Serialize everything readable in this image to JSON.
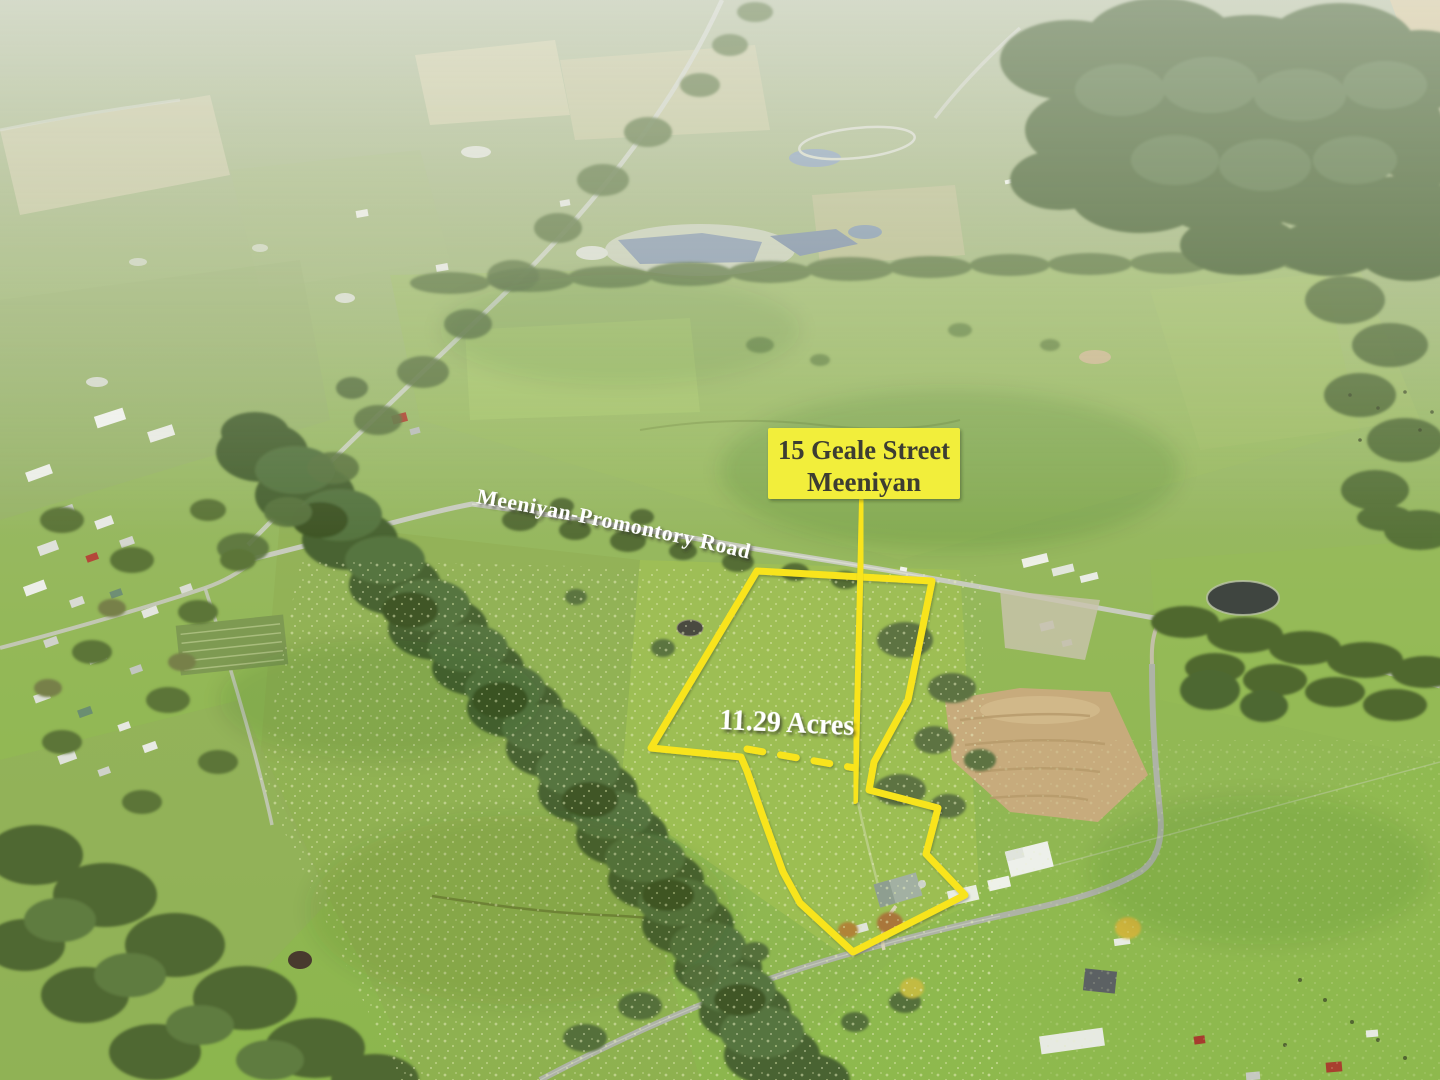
{
  "annotations": {
    "property_label": {
      "line1": "15 Geale Street",
      "line2": "Meeniyan"
    },
    "road_label": "Meeniyan-Promontory Road",
    "area_label": "11.29 Acres"
  },
  "colors": {
    "overlay_yellow": "#F8E41C",
    "label_box_fill": "#F2EE3B",
    "label_text_dark": "#3C3C30",
    "annotation_text_white": "#FFFFFF"
  }
}
